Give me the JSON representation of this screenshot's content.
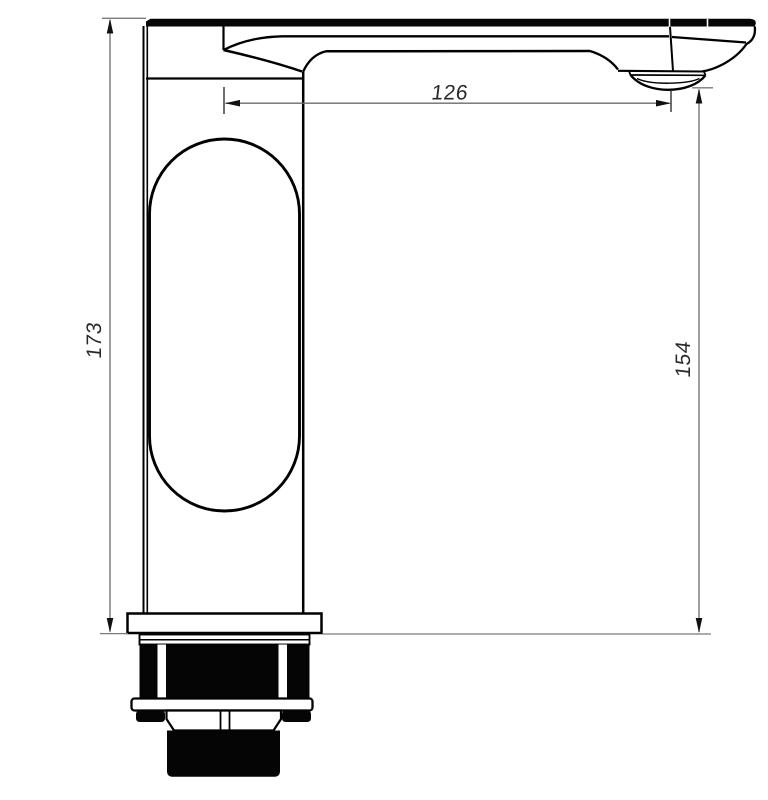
{
  "dimensions": {
    "total_height": {
      "value": "173",
      "position": "left",
      "orientation": "vertical"
    },
    "spout_reach": {
      "value": "126",
      "position": "top",
      "orientation": "horizontal"
    },
    "outlet_height": {
      "value": "154",
      "position": "right",
      "orientation": "vertical"
    }
  },
  "colors": {
    "outline": "#000000",
    "dimension_line": "#6b6b6b",
    "extension_line": "#7a7a7a",
    "arrow": "#111111",
    "label_text": "#2a2a2a",
    "background": "#ffffff"
  }
}
